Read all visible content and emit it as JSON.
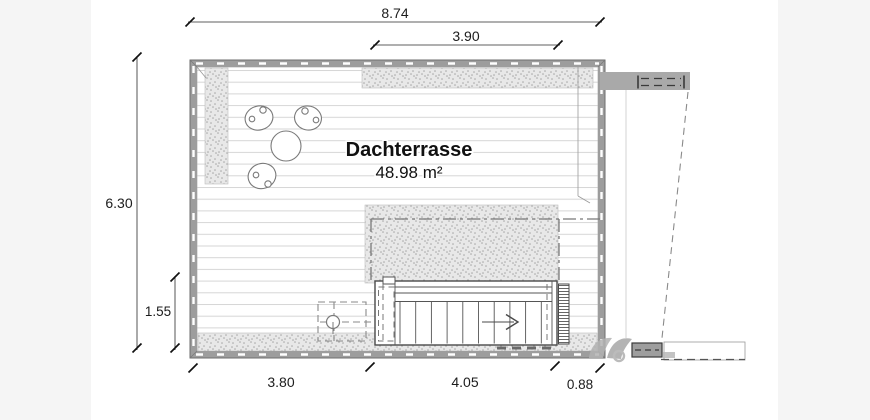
{
  "page": {
    "background_color": "#f5f5f5",
    "paper_color": "#ffffff"
  },
  "plan": {
    "room": {
      "name": "Dachterrasse",
      "area": "48.98 m²"
    },
    "dimensions": {
      "top_total": "8.74",
      "top_inner": "3.90",
      "left_total": "6.30",
      "left_inner": "1.55",
      "bottom_left": "3.80",
      "bottom_middle": "4.05",
      "bottom_right": "0.88"
    },
    "colors": {
      "wall_fill": "#9d9d9d",
      "stipple_fill": "#e8e8e8",
      "decking_line": "#d6d6d6",
      "dimension_text": "#1c1c1c"
    }
  }
}
